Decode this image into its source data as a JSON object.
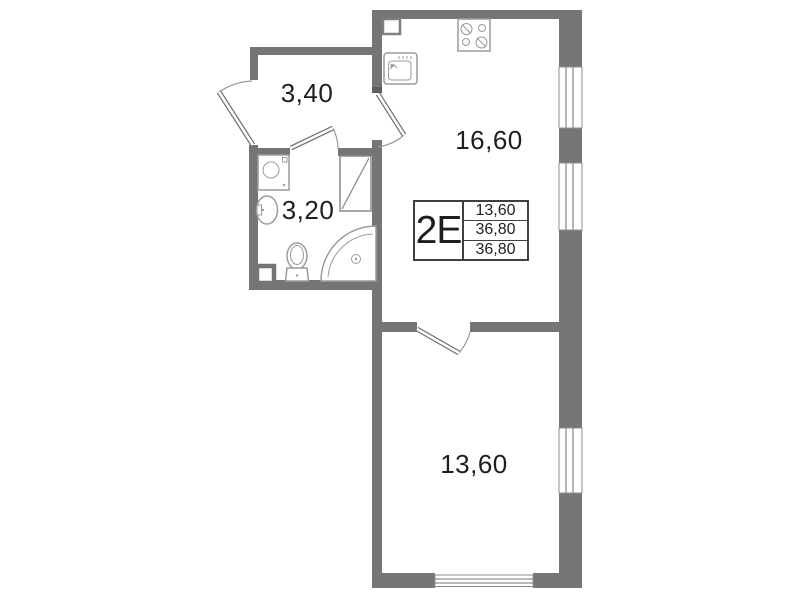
{
  "plan": {
    "unit": {
      "type_label": "2Е"
    },
    "info_table": {
      "values": [
        "13,60",
        "36,80",
        "36,80"
      ]
    },
    "rooms": {
      "hallway": {
        "name": "hallway",
        "area_label": "3,40"
      },
      "bathroom": {
        "name": "bathroom",
        "area_label": "3,20"
      },
      "kitchen_living": {
        "name": "kitchen-living-room",
        "area_label": "16,60"
      },
      "bedroom": {
        "name": "bedroom",
        "area_label": "13,60"
      }
    },
    "fixtures": [
      "stove-4-burner-icon",
      "kitchen-sink-icon",
      "vent-shaft-icon",
      "washing-machine-icon",
      "bathroom-sink-icon",
      "toilet-icon",
      "corner-bathtub-icon"
    ],
    "windows_count": 4,
    "doors_count": 4,
    "colors": {
      "wall": "#757575",
      "wall_dark": "#5e5e5e",
      "fixture": "#9b9b9b",
      "window_line": "#8f8f8f",
      "door_line": "#6e6e6e",
      "text": "#1e1e1e",
      "table_border": "#404040",
      "background": "#ffffff"
    }
  }
}
